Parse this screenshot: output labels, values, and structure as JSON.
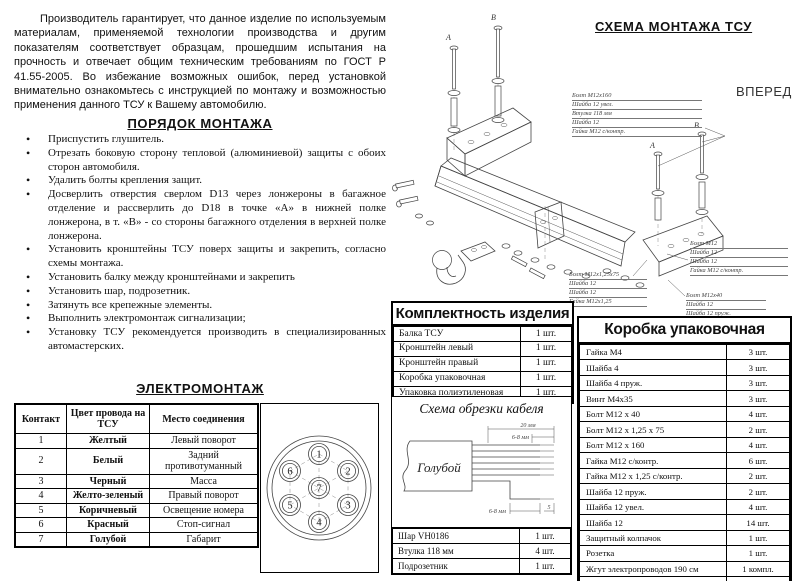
{
  "intro": {
    "text": "Производитель гарантирует, что данное изделие по используемым материалам, применяемой технологии производства и другим показателям соответствует образцам, прошедшим испытания на прочность и отвечает общим техническим требованиям по ГОСТ Р 41.55-2005. Во избежание возможных ошибок,  перед установкой внимательно ознакомьтесь с инструкцией по монтажу и возможностью применения данного ТСУ к Вашему автомобилю."
  },
  "montage": {
    "title": "ПОРЯДОК МОНТАЖА",
    "steps": [
      "Приспустить глушитель.",
      "Отрезать боковую сторону тепловой (алюминиевой) защиты с обоих сторон автомобиля.",
      "Удалить болты крепления защит.",
      "Досверлить отверстия сверлом D13 через лонжероны в багажное отделение и рассверлить до D18 в точке «А» в нижней полке лонжерона, в т. «В» - со стороны багажного отделения в верхней полке лонжерона.",
      "Установить кронштейны ТСУ поверх защиты и закрепить, согласно схемы монтажа.",
      "Установить балку между кронштейнами и закрепить",
      "Установить шар, подрозетник.",
      "Затянуть все крепежные элементы.",
      "Выполнить электромонтаж сигнализации;",
      "Установку ТСУ рекомендуется производить в специализированных автомастерских."
    ]
  },
  "electro": {
    "title": "ЭЛЕКТРОМОНТАЖ",
    "headers": [
      "Контакт",
      "Цвет провода на ТСУ",
      "Место соединения"
    ],
    "rows": [
      [
        "1",
        "Желтый",
        "Левый поворот"
      ],
      [
        "2",
        "Белый",
        "Задний противотуманный"
      ],
      [
        "3",
        "Черный",
        "Масса"
      ],
      [
        "4",
        "Желто-зеленый",
        "Правый поворот"
      ],
      [
        "5",
        "Коричневый",
        "Освещение номера"
      ],
      [
        "6",
        "Красный",
        "Стоп-сигнал"
      ],
      [
        "7",
        "Голубой",
        "Габарит"
      ]
    ],
    "pins": [
      "1",
      "2",
      "3",
      "4",
      "5",
      "6",
      "7"
    ]
  },
  "kit": {
    "title": "Комплектность изделия",
    "rows": [
      [
        "Балка ТСУ",
        "1 шт."
      ],
      [
        "Кронштейн левый",
        "1 шт."
      ],
      [
        "Кронштейн правый",
        "1 шт."
      ],
      [
        "Коробка упаковочная",
        "1 шт."
      ],
      [
        "Упаковка полиэтиленовая",
        "1 шт."
      ]
    ]
  },
  "box": {
    "title": "Коробка упаковочная",
    "rows": [
      [
        "Гайка М4",
        "3 шт."
      ],
      [
        "Шайба 4",
        "3 шт."
      ],
      [
        "Шайба 4 пруж.",
        "3 шт."
      ],
      [
        "Винт М4х35",
        "3 шт."
      ],
      [
        "Болт М12 х 40",
        "4 шт."
      ],
      [
        "Болт М12 х 1,25 х 75",
        "2 шт."
      ],
      [
        "Болт М12 х 160",
        "4 шт."
      ],
      [
        "Гайка М12 с/контр.",
        "6 шт."
      ],
      [
        "Гайка М12 х 1,25 с/контр.",
        "2 шт."
      ],
      [
        "Шайба 12 пруж.",
        "2 шт."
      ],
      [
        "Шайба 12 увел.",
        "4 шт."
      ],
      [
        "Шайба 12",
        "14 шт."
      ],
      [
        "Защитный колпачок",
        "1 шт."
      ],
      [
        "Розетка",
        "1 шт."
      ],
      [
        "Жгут электропроводов 190 см",
        "1 компл."
      ],
      [
        "Инструкция по монтажу",
        "1 шт."
      ]
    ]
  },
  "cable": {
    "title": "Схема обрезки кабеля",
    "sheath_label": "Голубой",
    "dim_total": "20 мм",
    "dim_strip_top": "6-8 мм",
    "dim_strip_bottom": "6-8 мм",
    "dim_right": "5"
  },
  "parts": {
    "rows": [
      [
        "Шар VH0186",
        "1 шт."
      ],
      [
        "Втулка 118 мм",
        "4 шт."
      ],
      [
        "Подрозетник",
        "1 шт."
      ]
    ]
  },
  "scheme": {
    "title": "СХЕМА МОНТАЖА ТСУ",
    "forward": "ВПЕРЕД",
    "point_a": "А",
    "point_b": "В",
    "annotations": {
      "a1": [
        "Болт М12х160",
        "Шайба 12 увел.",
        "Втулка 118 мм",
        "Шайба 12",
        "Гайка М12 с/контр."
      ],
      "a2": [
        "Болт М12",
        "Шайба 12",
        "Шайба 12",
        "Гайка М12 с/контр."
      ],
      "a3": [
        "Болт М12х40",
        "Шайба 12",
        "Шайба 12 пруж."
      ],
      "a4": [
        "Болт М12х1,25х75",
        "Шайба 12",
        "Шайба 12",
        "Гайка М12х1,25"
      ]
    }
  }
}
